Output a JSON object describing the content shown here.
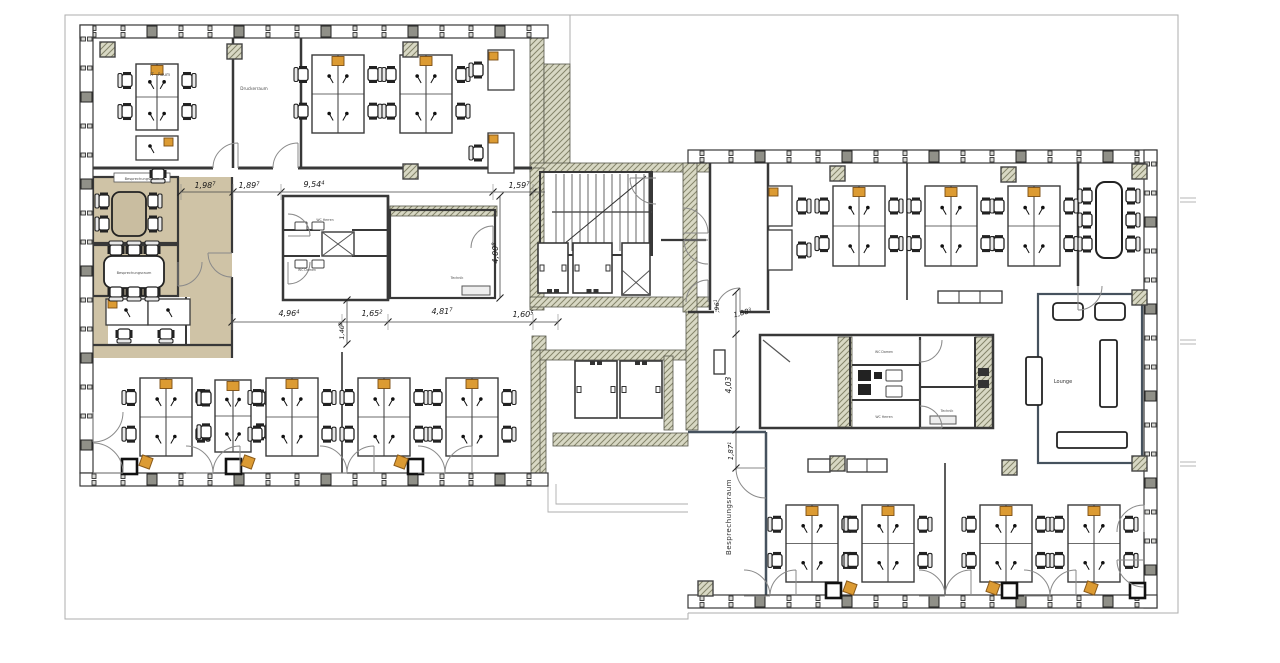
{
  "rooms": {
    "it_raum": "IT - Raum",
    "druckerraum": "Druckerraum",
    "meeting_upper": "Besprechungsraum",
    "meeting_lower": "Besprechungsraum",
    "meeting_right": "Besprechungsraum",
    "lounge": "Lounge",
    "technik_left": "Technik",
    "technik_right": "Technik",
    "wc_herren_left": "WC Herren",
    "wc_damen_left": "WC Damen",
    "wc_damen_right": "WC Damen",
    "wc_herren_right": "WC Herren"
  },
  "dims": {
    "d198": {
      "v": "1,98",
      "s": "7"
    },
    "d189": {
      "v": "1,89",
      "s": "7"
    },
    "d954": {
      "v": "9,54",
      "s": "4"
    },
    "d159": {
      "v": "1,59",
      "s": "7"
    },
    "d496": {
      "v": "4,96",
      "s": "4"
    },
    "d140": {
      "v": "1,40",
      "s": "8"
    },
    "d165": {
      "v": "1,65",
      "s": "2"
    },
    "d481": {
      "v": "4,81",
      "s": "7"
    },
    "d160": {
      "v": "1,60",
      "s": "5"
    },
    "d400": {
      "v": "4,00",
      "s": "8"
    },
    "d096": {
      "v": ",96",
      "s": "1"
    },
    "d188": {
      "v": "1,88",
      "s": "3"
    },
    "d403": {
      "v": "4,03",
      "s": ""
    },
    "d187": {
      "v": "1,87",
      "s": "1"
    }
  },
  "colors": {
    "floor_tan": "#cfc3a6",
    "accent_orange": "#dc9b33",
    "wall": "#383838",
    "glass_partition": "#46525e",
    "hatch_fill": "#d8d8c4",
    "hatch_line": "#84846a",
    "terrace_line": "#adadad"
  }
}
